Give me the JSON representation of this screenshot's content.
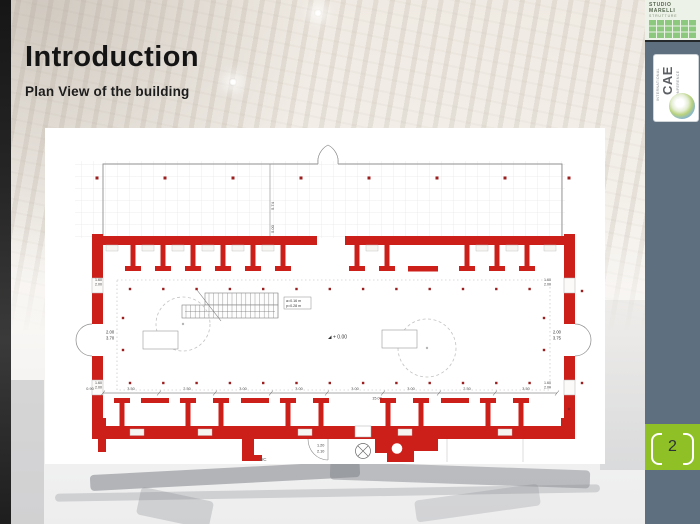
{
  "slide": {
    "title": "Introduction",
    "subtitle": "Plan View of the building",
    "page_number": "2"
  },
  "logos": {
    "studio": {
      "line1": "STUDIO",
      "line2": "MARELLI",
      "line3": "STRUTTURE"
    },
    "cae": {
      "acronym": "CAE",
      "top_word": "INTERNATIONAL",
      "bottom_word": "CONFERENCE"
    }
  },
  "plan": {
    "level_marker": "+ 0.00",
    "stairs_note_line1": "a=0.16 m",
    "stairs_note_line2": "p=0.28 m",
    "wc_label": "WC",
    "door_left": {
      "width": "2.00",
      "height": "3.70"
    },
    "door_right": {
      "width": "2.00",
      "height": "3.75"
    },
    "door_wc": {
      "width": "1.20",
      "height": "2.10"
    },
    "portico_dims": [
      "5.74",
      "5.00"
    ],
    "side_dims": [
      "1.60",
      "2.00"
    ],
    "left_dim": "0.90",
    "bottom_dims": [
      "3.50",
      "2.50",
      "3.00",
      "3.00",
      "3.00",
      "3.00",
      "2.50",
      "3.50"
    ],
    "bottom_total": "15.00"
  },
  "colors": {
    "wall_red": "#cc1f1a",
    "column_dot": "#9c1f1f",
    "accent_green": "#8fc026",
    "sidebar_gray": "#5e7080",
    "logo_square_green": "#8cc87e"
  }
}
